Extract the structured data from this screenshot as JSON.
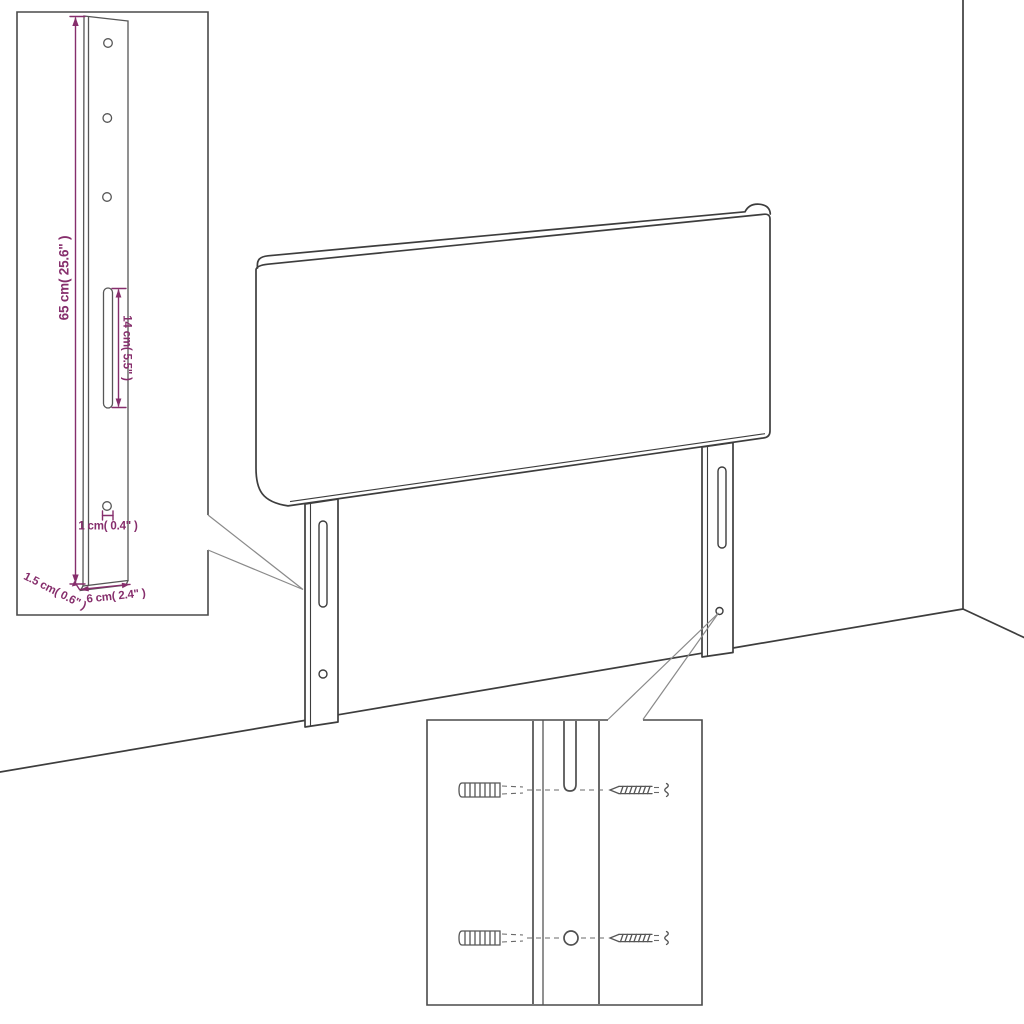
{
  "diagram": {
    "colors": {
      "line_art": "#3d3d3d",
      "detail_lines": "#565656",
      "dimension": "#862e6c",
      "callout": "#8a8a8a",
      "background": "#ffffff"
    },
    "leg_detail_inset": {
      "labels": {
        "leg_height": "65 cm( 25.6\" )",
        "slot_length": "14 cm( 5.5\" )",
        "hole_diameter": "1 cm( 0.4\" )",
        "leg_thickness": "1.5 cm( 0.6\" )",
        "leg_width": "6 cm( 2.4\" )"
      }
    }
  }
}
